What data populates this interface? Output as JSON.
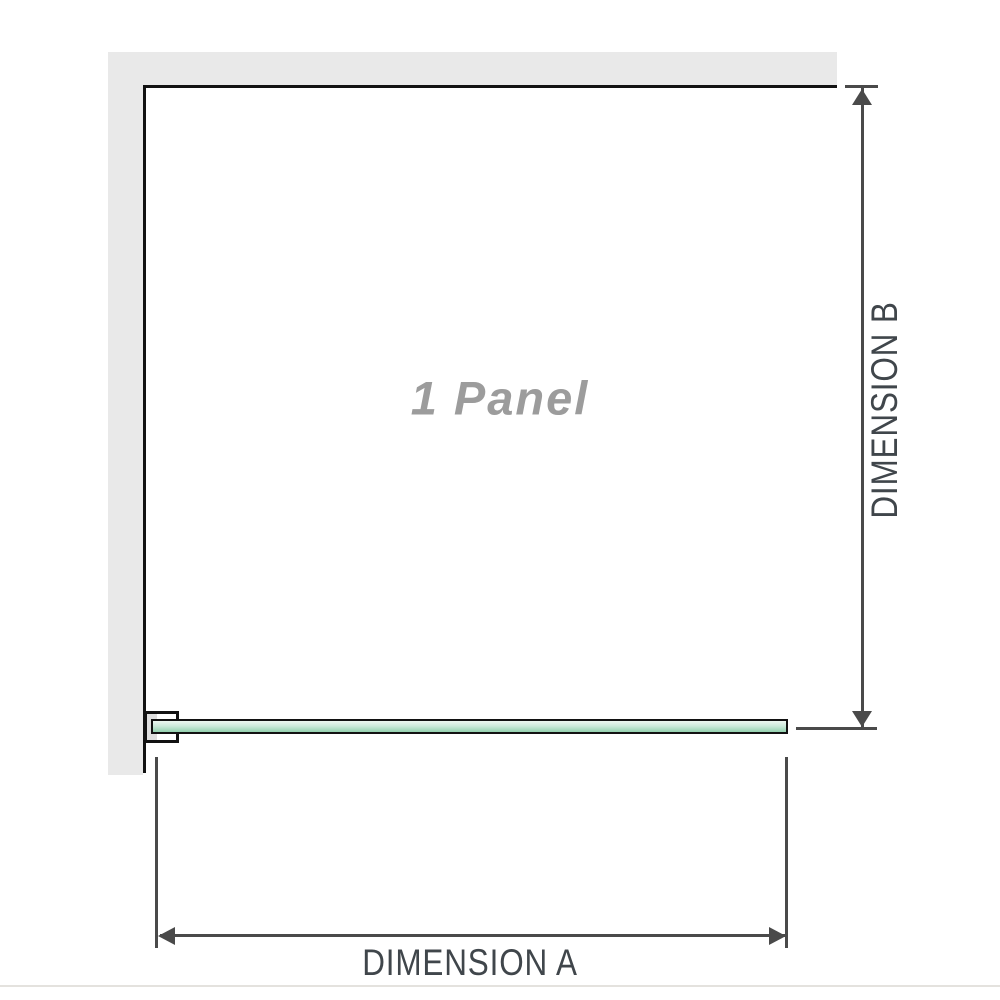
{
  "diagram": {
    "panel_label": "1 Panel",
    "dimension_a_label": "DIMENSION A",
    "dimension_b_label": "DIMENSION B"
  },
  "icons": {
    "arrow_up_icon": "▲",
    "arrow_down_icon": "▼",
    "arrow_left_icon": "◀",
    "arrow_right_icon": "▶"
  },
  "colors": {
    "wall_gray": "#e9e9e9",
    "frame_black": "#121212",
    "dim_gray": "#4a4a4a",
    "dim_text": "#40464b",
    "label_gray": "#9c9c9c",
    "glass_green_light": "#edf7f1",
    "glass_green": "#93d1ae",
    "divider": "#e4e2de"
  }
}
